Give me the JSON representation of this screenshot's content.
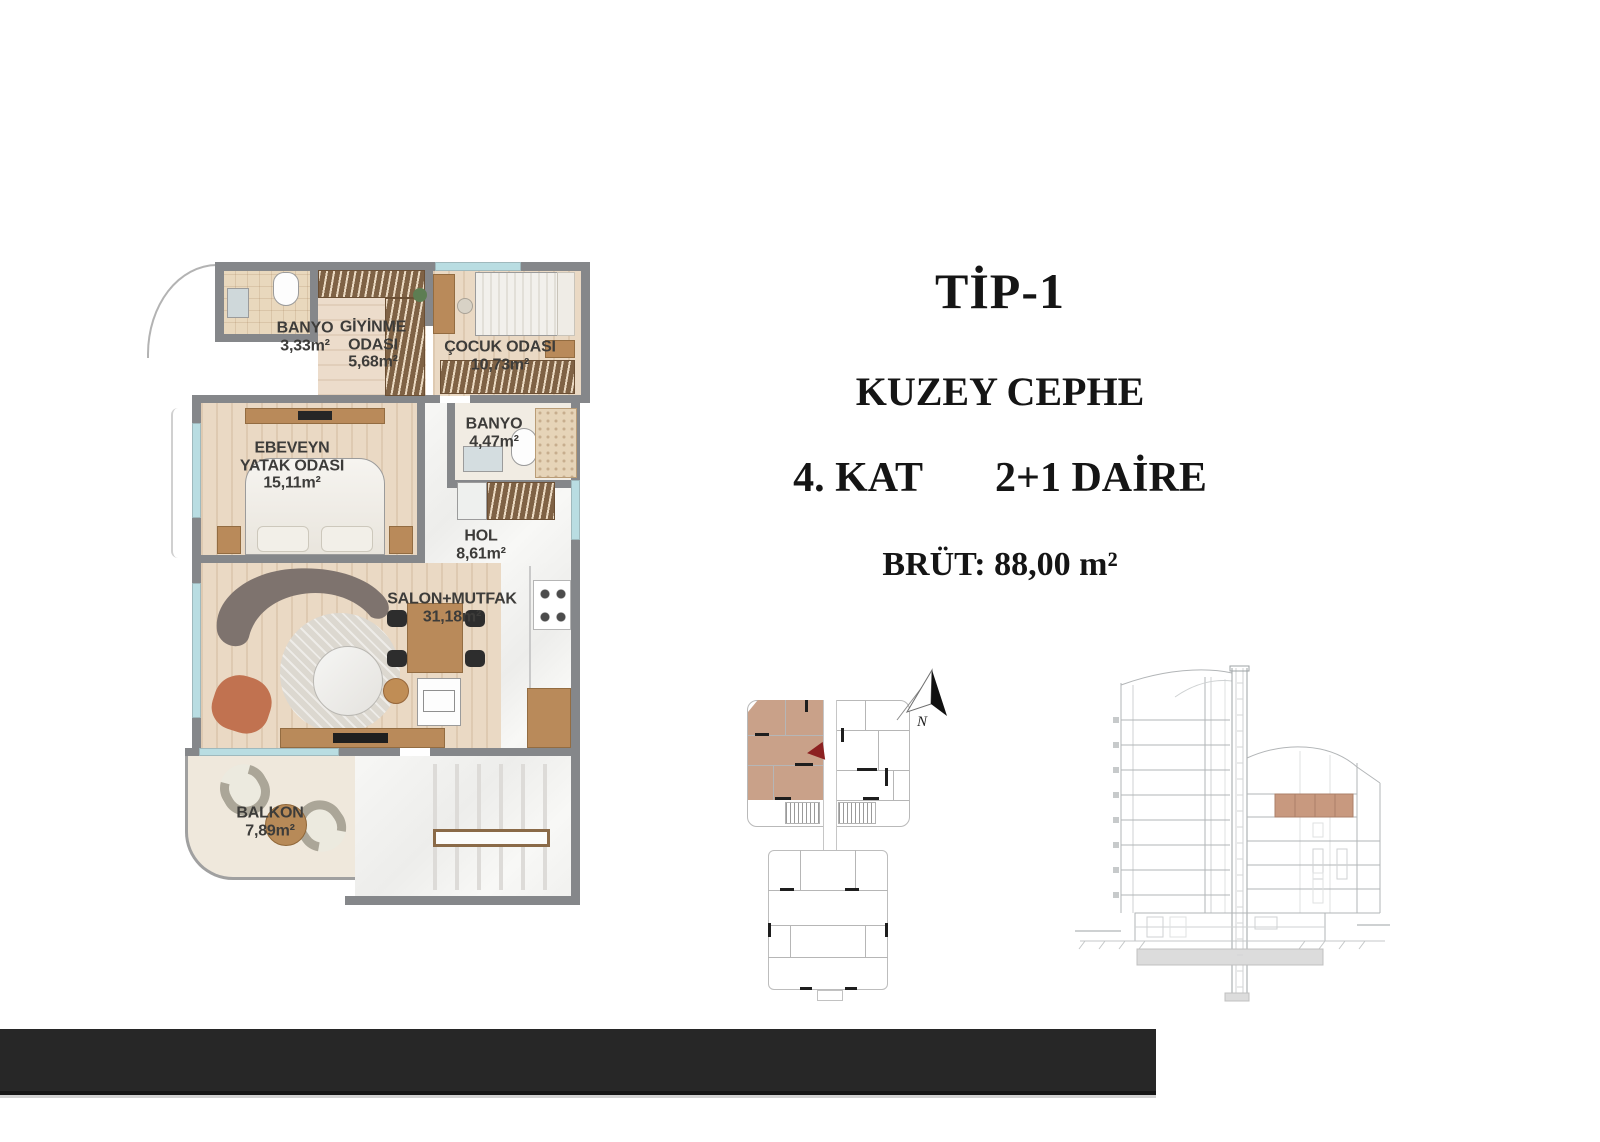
{
  "document": {
    "type_label": "TİP-1",
    "facade_label": "KUZEY CEPHE",
    "floor_label": "4. KAT",
    "unit_label": "2+1 DAİRE",
    "gross_area_label": "BRÜT: 88,00 m²"
  },
  "floor_plan": {
    "rooms": [
      {
        "name": "BANYO",
        "area": "3,33m²"
      },
      {
        "name": "GİYİNME ODASI",
        "area": "5,68m²"
      },
      {
        "name": "ÇOCUK ODASI",
        "area": "10,73m²"
      },
      {
        "name": "BANYO",
        "area": "4,47m²"
      },
      {
        "name": "EBEVEYN YATAK ODASI",
        "area": "15,11m²"
      },
      {
        "name": "HOL",
        "area": "8,61m²"
      },
      {
        "name": "SALON+MUTFAK",
        "area": "31,18m²"
      },
      {
        "name": "BALKON",
        "area": "7,89m²"
      }
    ]
  },
  "key_plan": {
    "north_label": "N",
    "highlight_color": "#c9a189",
    "arrow_color": "#8c2121"
  },
  "section_view": {
    "highlight_color": "#c8997f"
  },
  "colors": {
    "wall_gray": "#85878a",
    "window_blue": "#b9dde2",
    "bottom_bar": "#272727"
  }
}
